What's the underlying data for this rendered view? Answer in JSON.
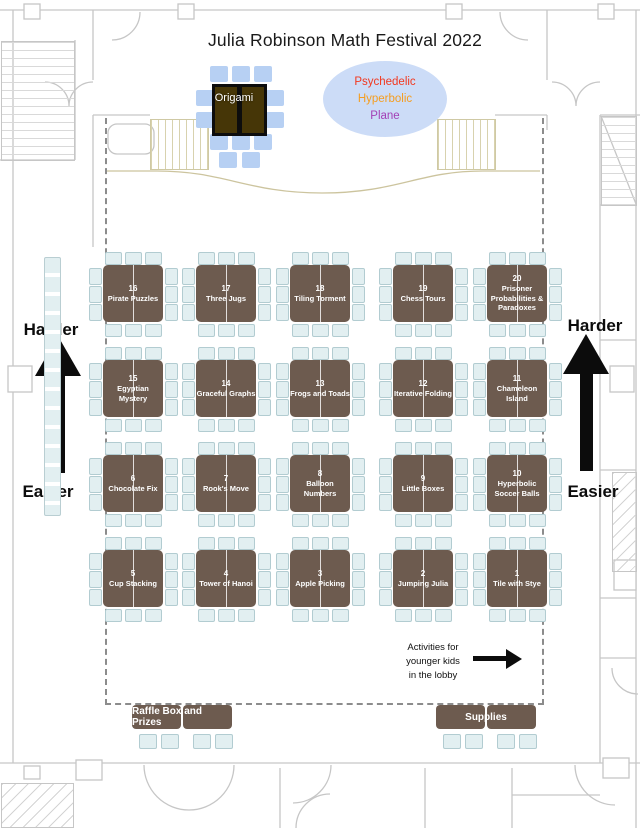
{
  "title": "Julia Robinson Math Festival 2022",
  "origami_station": {
    "label": "Origami"
  },
  "hyperbolic_plane_sign": {
    "line1": "Psychedelic",
    "line2": "Hyperbolic",
    "line3": "Plane",
    "colors": {
      "line1": "#f2381f",
      "line2": "#f59d1f",
      "line3": "#a33fb5"
    }
  },
  "difficulty_scale": {
    "harder": "Harder",
    "easier": "Easier"
  },
  "activity_tables": {
    "rows": [
      [
        {
          "number": "16",
          "name": "Pirate Puzzles"
        },
        {
          "number": "17",
          "name": "Three Jugs"
        },
        {
          "number": "18",
          "name": "Tiling Torment"
        },
        {
          "number": "19",
          "name": "Chess Tours"
        },
        {
          "number": "20",
          "name": "Prisoner Probabilities & Paradoxes"
        }
      ],
      [
        {
          "number": "15",
          "name": "Egyptian Mystery"
        },
        {
          "number": "14",
          "name": "Graceful Graphs"
        },
        {
          "number": "13",
          "name": "Frogs and Toads"
        },
        {
          "number": "12",
          "name": "Iterative Folding"
        },
        {
          "number": "11",
          "name": "Chameleon Island"
        }
      ],
      [
        {
          "number": "6",
          "name": "Chocolate Fix"
        },
        {
          "number": "7",
          "name": "Rook's Move"
        },
        {
          "number": "8",
          "name": "Balloon Numbers"
        },
        {
          "number": "9",
          "name": "Little Boxes"
        },
        {
          "number": "10",
          "name": "Hyperbolic Soccer Balls"
        }
      ],
      [
        {
          "number": "5",
          "name": "Cup Stacking"
        },
        {
          "number": "4",
          "name": "Tower of Hanoi"
        },
        {
          "number": "3",
          "name": "Apple Picking"
        },
        {
          "number": "2",
          "name": "Jumping Julia"
        },
        {
          "number": "1",
          "name": "Tile with Stye"
        }
      ]
    ]
  },
  "stray_placeholder": "Text",
  "service_tables": {
    "raffle": "Raffle Box and Prizes",
    "supplies": "Supplies"
  },
  "lobby_note": {
    "line1": "Activities for",
    "line2": "younger kids",
    "line3": "in the lobby"
  },
  "colors": {
    "activity_table": "#6d5b4f",
    "chair": "#e2eff1",
    "origami_chair": "#b7d0f3",
    "origami_table": "#463607",
    "sign_ellipse": "#ccdcf7"
  }
}
